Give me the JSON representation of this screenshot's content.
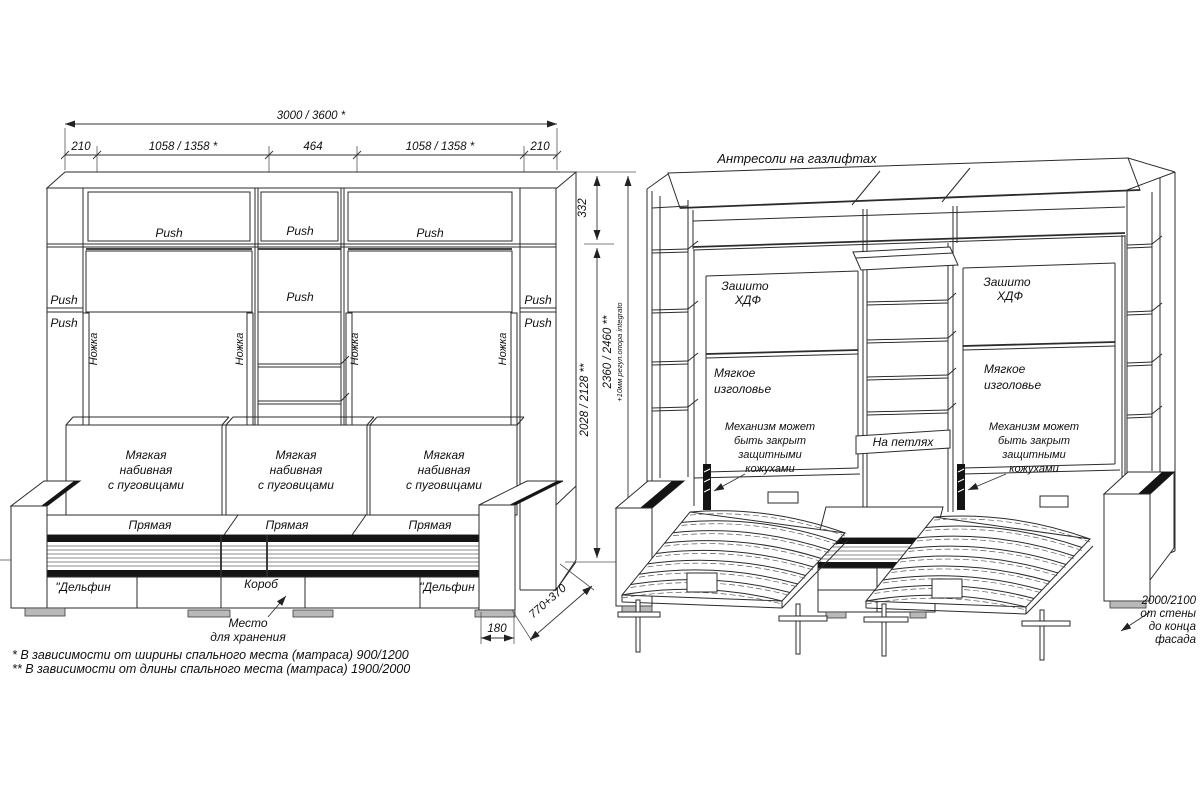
{
  "left_view": {
    "dims": {
      "total_width": "3000 / 3600 *",
      "side_left": "210",
      "bay_left": "1058 / 1358 *",
      "center": "464",
      "bay_right": "1058 / 1358 *",
      "side_right": "210",
      "antresol_height": "332",
      "inner_height": "2028 / 2128 **",
      "total_height": "2360 / 2460 **",
      "support_note": "+10мм регул.опора integrato",
      "plinth_depth": "180",
      "bed_depth": "770+370"
    },
    "labels": {
      "push": "Push",
      "leg": "Ножка",
      "cushion": [
        "Мягкая",
        "набивная",
        "с пуговицами"
      ],
      "straight": "Прямая",
      "dolphin": "\"Дельфин",
      "box": "Короб",
      "storage": [
        "Место",
        "для хранения"
      ]
    },
    "footnotes": [
      "* В зависимости от ширины спального места (матраса) 900/1200",
      "** В зависимости от длины спального места (матраса) 1900/2000"
    ]
  },
  "right_view": {
    "title": "Антресоли на газлифтах",
    "labels": {
      "hdf": [
        "Зашито",
        "ХДФ"
      ],
      "headboard": [
        "Мягкое",
        "изголовье"
      ],
      "mechanism": [
        "Механизм может",
        "быть закрыт",
        "защитными",
        "кожухами"
      ],
      "hinges": "На петлях",
      "wall_depth": [
        "2000/2100",
        "от стены",
        "до конца",
        "фасада"
      ]
    }
  }
}
